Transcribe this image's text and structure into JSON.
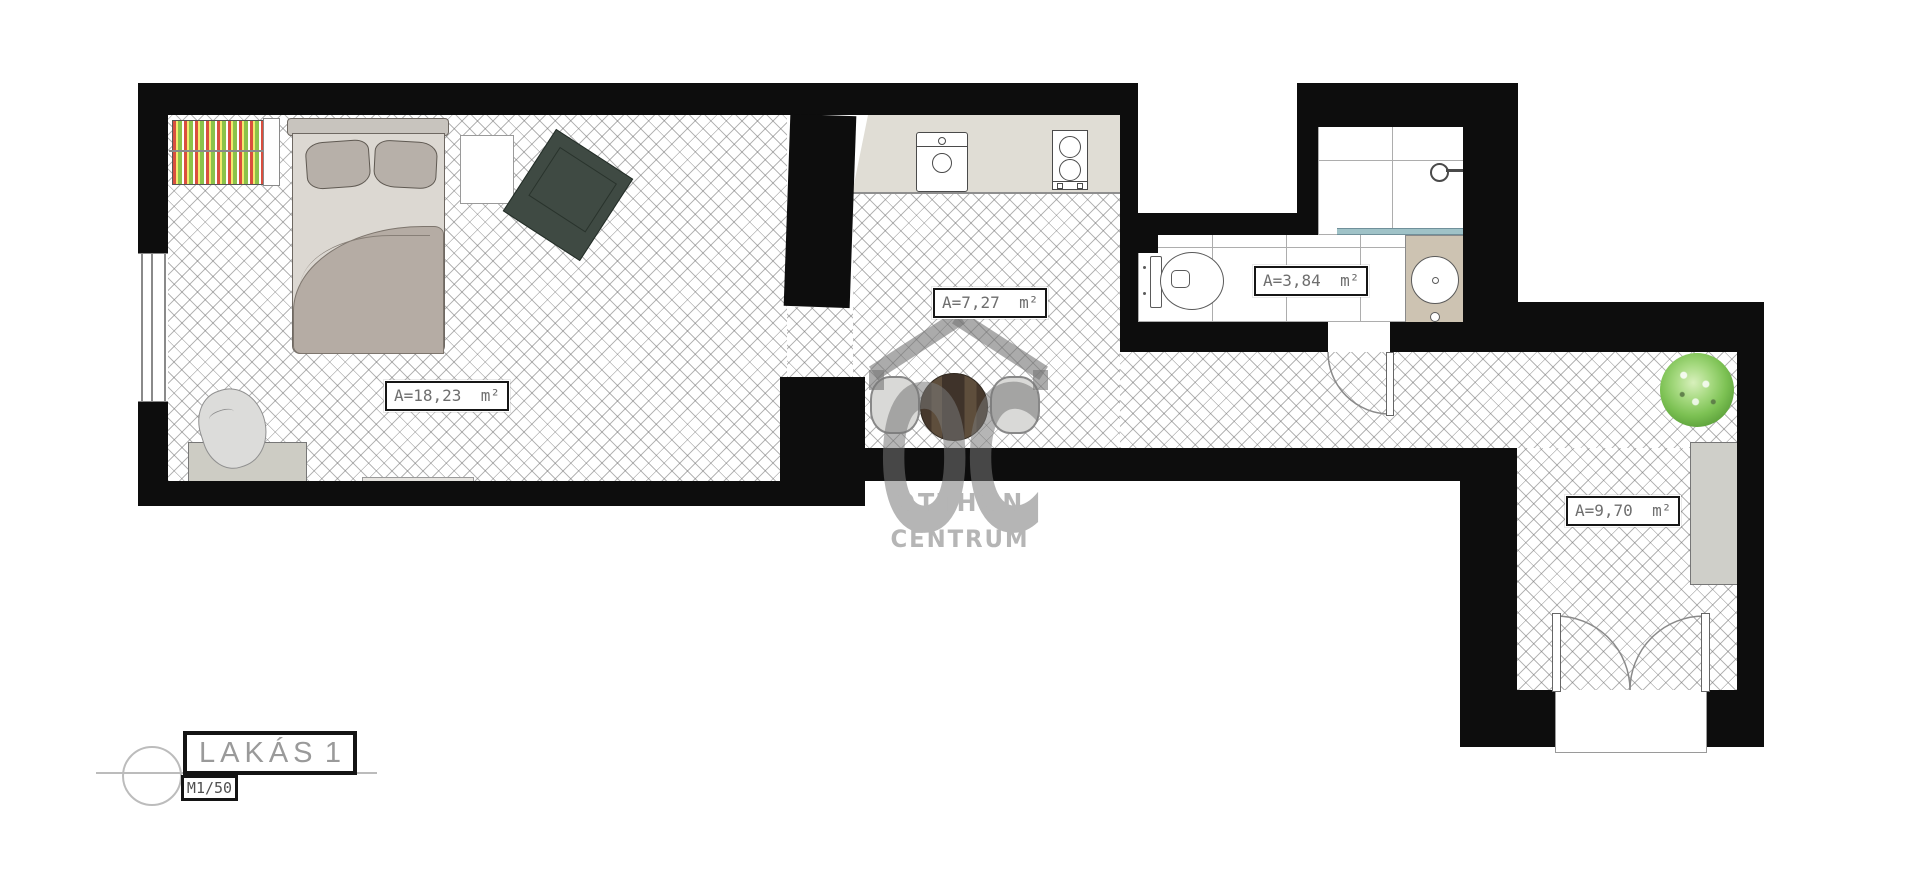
{
  "watermark": {
    "monogram": "OC",
    "line1": "OTTHON",
    "line2": "CENTRUM"
  },
  "title_block": {
    "title": "LAKÁS",
    "number": "1",
    "scale": "M1/50"
  },
  "rooms": {
    "bedroom": {
      "name": "bedroom",
      "area_label": "A=18,23  m²"
    },
    "kitchen": {
      "name": "kitchen-dining",
      "area_label": "A=7,27  m²"
    },
    "bathroom": {
      "name": "bathroom",
      "area_label": "A=3,84  m²"
    },
    "hall": {
      "name": "entrance-hall",
      "area_label": "A=9,70  m²"
    }
  },
  "colors": {
    "wall": "#0d0d0d",
    "counter": "#e0ddd5",
    "dining_table": "#4b3d31",
    "plant": "#7cc153",
    "basin_cabinet": "#cdc3b2",
    "watermark_gray": "#a9a9a9",
    "label_text": "#6e6e6e",
    "glass_partition": "#9fc2c7"
  }
}
